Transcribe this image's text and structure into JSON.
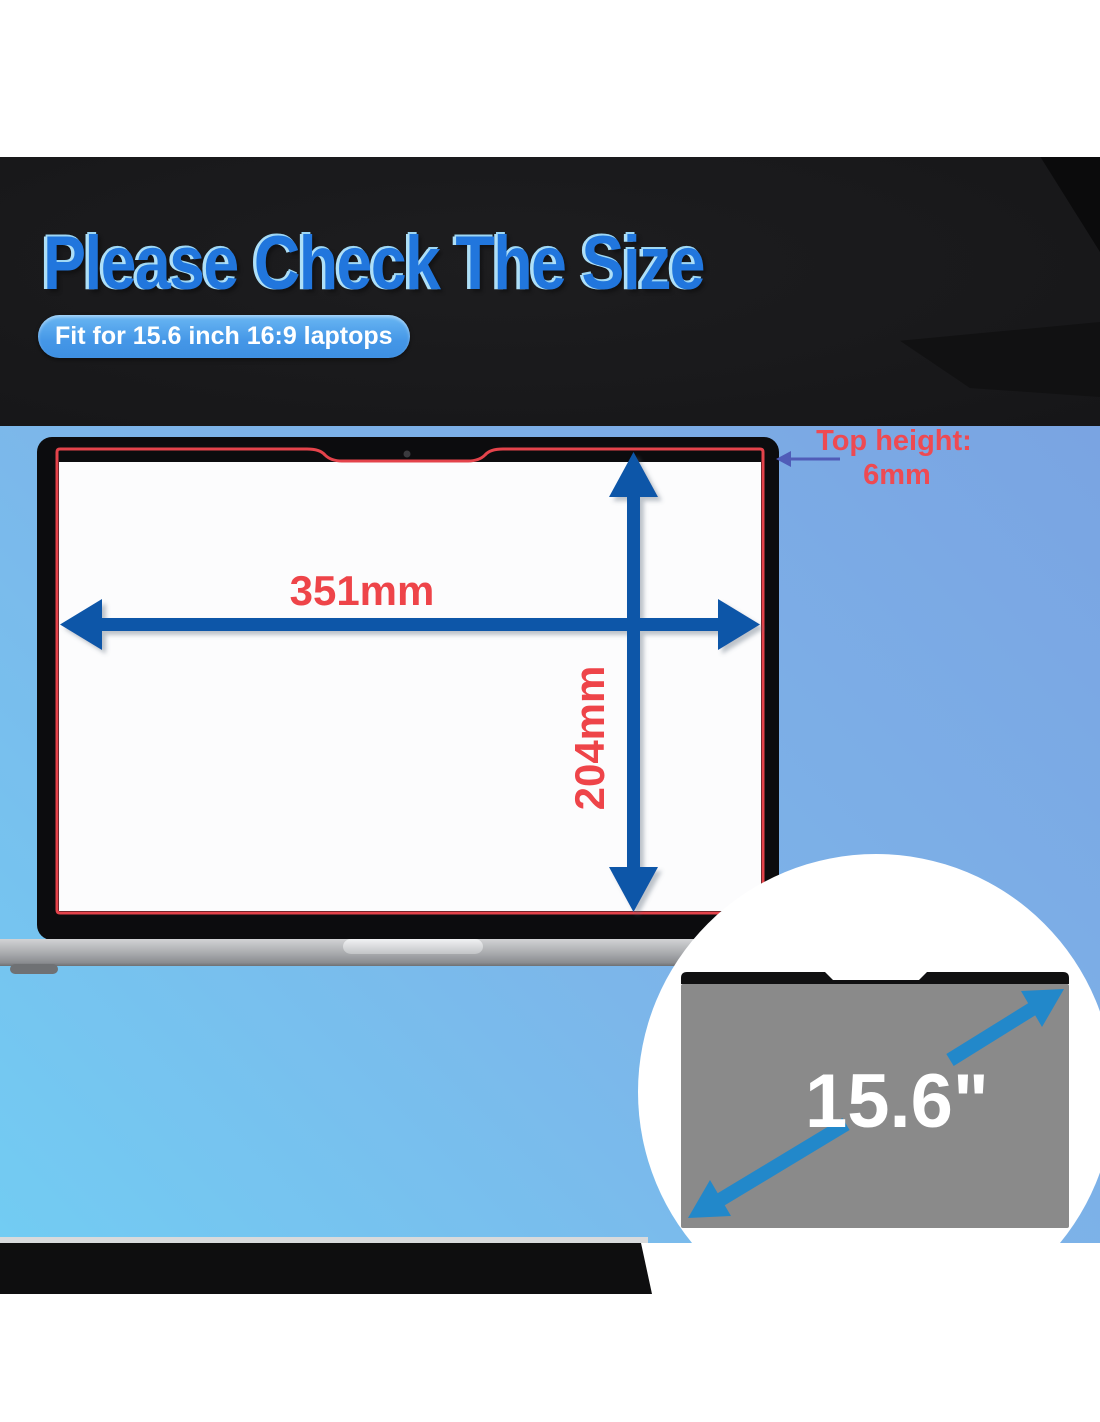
{
  "banner": {
    "title": "Please Check The Size",
    "badge": "Fit for 15.6 inch 16:9 laptops"
  },
  "measurements": {
    "width": "351mm",
    "height": "204mm",
    "top_height_line1": "Top height:",
    "top_height_line2": "6mm",
    "diagonal": "15.6\""
  },
  "colors": {
    "title_blue": "#2176dd",
    "title_highlight": "#aedff7",
    "badge_blue": "#4a9ce9",
    "background_blue_top": "#7aa4e2",
    "background_blue_bottom": "#72ccf3",
    "dimension_red": "#e8434b",
    "arrow_dark_blue": "#1156a8",
    "pointer_indigo": "#505cb8",
    "inset_arrow_blue": "#2288ca",
    "filter_gray": "#8a8a8a",
    "banner_black": "#19191b"
  }
}
